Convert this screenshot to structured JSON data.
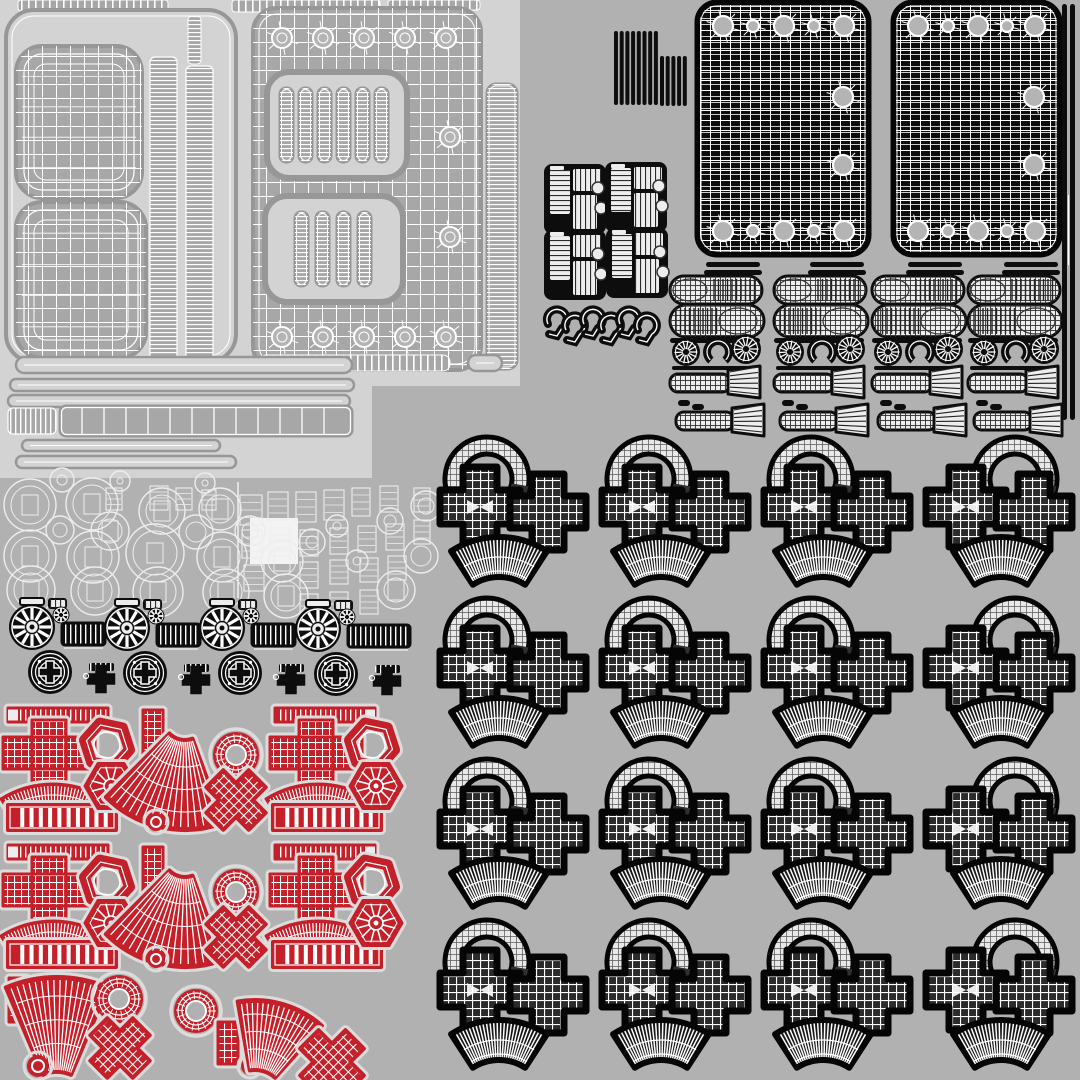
{
  "meta": {
    "description": "UV wireframe texture atlas sheet of 3D model parts",
    "canvas": {
      "w": 1080,
      "h": 1080
    }
  },
  "palette": {
    "bg": "#B1B1B1",
    "light": "#D3D3D3",
    "gray": "#A7A7A7",
    "grayEdge": "#979797",
    "white": "#FFFFFF",
    "ink": "#0D0D0D",
    "outline": "#050505",
    "meshDark": "#2B2B2B",
    "ringFill": "#E8E8E8",
    "red": "#C4202A",
    "halo": "#DCDCDC",
    "holeGray": "#B4B4B4",
    "fanDark": "#161616",
    "wireLight": "#EDEDED"
  },
  "patterns": [
    {
      "id": "gw7",
      "size": 7,
      "h": true,
      "v": true,
      "color": "#FFFFFF",
      "lw": 1.1
    },
    {
      "id": "gw8",
      "size": 8,
      "h": true,
      "v": true,
      "color": "#FFFFFF",
      "lw": 1.2
    },
    {
      "id": "gw10",
      "size": 10,
      "h": true,
      "v": true,
      "color": "#FFFFFF",
      "lw": 1.0
    },
    {
      "id": "hl6",
      "size": 6,
      "h": true,
      "v": false,
      "color": "#FFFFFF",
      "lw": 0.8
    },
    {
      "id": "gl14",
      "size": 14,
      "h": true,
      "v": true,
      "color": "#FFFFFF",
      "lw": 1.0
    },
    {
      "id": "gd6",
      "size": 6,
      "h": true,
      "v": true,
      "color": "#606060",
      "lw": 0.8
    },
    {
      "id": "sv5",
      "size": 5,
      "h": false,
      "v": true,
      "color": "#FFFFFF",
      "lw": 1.8
    },
    {
      "id": "sv7",
      "size": 7,
      "h": false,
      "v": true,
      "color": "#FFFFFF",
      "lw": 2.2
    },
    {
      "id": "sh4",
      "size": 4,
      "h": true,
      "v": false,
      "color": "#FFFFFF",
      "lw": 1.3
    },
    {
      "id": "shd5",
      "size": 5,
      "h": true,
      "v": false,
      "color": "#2A2A2A",
      "lw": 1.2
    },
    {
      "id": "svd5",
      "size": 5,
      "h": false,
      "v": true,
      "color": "#2A2A2A",
      "lw": 1.2
    },
    {
      "id": "gdk5",
      "size": 5,
      "h": true,
      "v": true,
      "color": "#2F2F2F",
      "lw": 0.9
    }
  ],
  "light_rects": [
    [
      0,
      0,
      520,
      386
    ],
    [
      0,
      0,
      372,
      478
    ]
  ],
  "top_bars": [
    [
      18,
      0,
      150,
      11
    ],
    [
      26,
      12,
      140,
      9
    ],
    [
      232,
      0,
      148,
      12
    ],
    [
      388,
      0,
      92,
      10
    ]
  ],
  "frame": {
    "x": 6,
    "y": 10,
    "w": 230,
    "h": 352,
    "r": 28
  },
  "pads": [
    [
      16,
      46,
      126,
      152,
      26
    ],
    [
      16,
      202,
      130,
      156,
      26
    ]
  ],
  "columns": [
    [
      150,
      57,
      27,
      305
    ],
    [
      186,
      66,
      27,
      296
    ]
  ],
  "minibar": [
    188,
    16,
    13,
    48
  ],
  "panel": {
    "x": 253,
    "y": 8,
    "w": 228,
    "h": 362,
    "r": 24,
    "holes_x": [
      282,
      323,
      364,
      405,
      446
    ],
    "holes_top_y": 38,
    "holes_bot_y": 337,
    "right_holes": [
      [
        450,
        137
      ],
      [
        450,
        237
      ]
    ],
    "cutouts": [
      {
        "x": 267,
        "y": 72,
        "w": 140,
        "h": 106,
        "r": 22,
        "slots": 6,
        "slot_x0": 280,
        "slot_pitch": 19,
        "slot_y": 88,
        "slot_w": 13,
        "slot_h": 74
      },
      {
        "x": 265,
        "y": 196,
        "w": 138,
        "h": 106,
        "r": 22,
        "slots": 4,
        "slot_x0": 295,
        "slot_pitch": 21,
        "slot_y": 212,
        "slot_w": 13,
        "slot_h": 74
      }
    ]
  },
  "side_strip": [
    487,
    84,
    30,
    285
  ],
  "long_bars": {
    "outline": [
      [
        16,
        357,
        336,
        16
      ],
      [
        468,
        355,
        34,
        16
      ]
    ],
    "striped": [
      [
        260,
        355,
        190,
        16
      ]
    ],
    "thin": [
      [
        10,
        379,
        344,
        12
      ],
      [
        8,
        395,
        342,
        12
      ],
      [
        22,
        440,
        198,
        11
      ],
      [
        16,
        456,
        220,
        12
      ]
    ],
    "seg_small": [
      8,
      408,
      48,
      26
    ],
    "seg_big": [
      60,
      406,
      292,
      30
    ]
  },
  "washers": {
    "line_x": 238,
    "blob": [
      250,
      518,
      48,
      46
    ],
    "circles": [
      [
        30,
        505,
        26
      ],
      [
        92,
        504,
        26
      ],
      [
        30,
        556,
        26
      ],
      [
        93,
        557,
        26
      ],
      [
        31,
        590,
        24
      ],
      [
        95,
        591,
        24
      ],
      [
        155,
        553,
        29
      ],
      [
        158,
        592,
        25
      ],
      [
        110,
        531,
        19
      ],
      [
        162,
        511,
        23
      ],
      [
        220,
        509,
        21
      ],
      [
        222,
        557,
        25
      ],
      [
        226,
        592,
        23
      ],
      [
        282,
        561,
        21
      ],
      [
        286,
        596,
        22
      ],
      [
        196,
        532,
        17
      ],
      [
        250,
        531,
        15
      ],
      [
        312,
        542,
        13
      ],
      [
        337,
        526,
        11
      ],
      [
        357,
        561,
        11
      ],
      [
        390,
        521,
        13
      ],
      [
        396,
        590,
        19
      ],
      [
        421,
        556,
        17
      ],
      [
        426,
        506,
        15
      ],
      [
        62,
        480,
        12
      ],
      [
        120,
        481,
        10
      ],
      [
        205,
        483,
        10
      ],
      [
        60,
        530,
        14
      ]
    ],
    "rects": [
      [
        240,
        495,
        22,
        30
      ],
      [
        268,
        492,
        20,
        28
      ],
      [
        296,
        492,
        20,
        30
      ],
      [
        324,
        490,
        20,
        30
      ],
      [
        352,
        488,
        18,
        28
      ],
      [
        380,
        486,
        18,
        26
      ],
      [
        242,
        530,
        20,
        28
      ],
      [
        270,
        528,
        20,
        28
      ],
      [
        300,
        530,
        18,
        26
      ],
      [
        330,
        528,
        18,
        26
      ],
      [
        358,
        526,
        18,
        26
      ],
      [
        386,
        524,
        18,
        26
      ],
      [
        244,
        565,
        20,
        26
      ],
      [
        300,
        562,
        18,
        26
      ],
      [
        330,
        560,
        18,
        24
      ],
      [
        360,
        558,
        18,
        24
      ],
      [
        388,
        556,
        18,
        24
      ],
      [
        414,
        488,
        16,
        24
      ],
      [
        414,
        520,
        16,
        24
      ],
      [
        150,
        486,
        18,
        24
      ],
      [
        176,
        488,
        16,
        22
      ],
      [
        202,
        490,
        14,
        20
      ],
      [
        106,
        488,
        16,
        22
      ],
      [
        300,
        594,
        18,
        24
      ],
      [
        330,
        592,
        18,
        24
      ],
      [
        360,
        590,
        18,
        24
      ]
    ]
  },
  "wheels": {
    "centers": [
      [
        32,
        627
      ],
      [
        127,
        628
      ],
      [
        222,
        628
      ],
      [
        318,
        629
      ]
    ],
    "bar_w": [
      43,
      43,
      43,
      62
    ]
  },
  "coil": {
    "tall": {
      "x": 614,
      "y": 31,
      "n": 8,
      "pitch": 5.7,
      "w": 4,
      "h": 74
    },
    "short": {
      "x": 660,
      "y": 56,
      "n": 5,
      "pitch": 5.7,
      "w": 4,
      "h": 50
    }
  },
  "connectors": [
    [
      548,
      168
    ],
    [
      609,
      166
    ],
    [
      548,
      234
    ],
    [
      610,
      232
    ]
  ],
  "hooks": {
    "x0": 548,
    "ys": [
      306,
      312
    ],
    "n": 6,
    "pitch": 18
  },
  "black_panels": [
    {
      "x": 697,
      "y": 2,
      "w": 172,
      "h": 253,
      "hx": [
        26,
        56,
        87,
        117,
        147
      ],
      "hr": [
        10,
        6,
        10,
        6,
        10
      ],
      "ry": [
        95,
        163
      ]
    },
    {
      "x": 893,
      "y": 2,
      "w": 167,
      "h": 253,
      "hx": [
        25,
        55,
        85,
        114,
        142
      ],
      "hr": [
        10,
        6,
        10,
        6,
        10
      ],
      "ry": [
        95,
        163
      ]
    }
  ],
  "edge_bars": [
    [
      1062,
      4,
      5,
      416
    ],
    [
      1070,
      4,
      5,
      416
    ]
  ],
  "grips": {
    "cols": [
      668,
      772,
      870,
      966
    ]
  },
  "pattern": {
    "cols": [
      430,
      592,
      754,
      916
    ],
    "rows": [
      437,
      598,
      759,
      920
    ],
    "ringdx": [
      57,
      57,
      57,
      99
    ],
    "fandx": [
      69,
      69,
      69,
      85
    ],
    "ring": {
      "r1": 25,
      "r2": 42,
      "a1": -215,
      "a2": 32,
      "cy": 42
    },
    "crossA": {
      "dx": 50,
      "dy": 70,
      "arm": 40,
      "hw": 17
    },
    "crossB": {
      "dx": 118,
      "dy": 75,
      "arm": 38,
      "hw": 16
    },
    "fan": {
      "cy": 188,
      "r1": 48,
      "r2": 88,
      "a1": -123,
      "a2": -57,
      "rays": 26
    }
  },
  "red": {
    "rows_dy": [
      0,
      137
    ],
    "template": [
      {
        "t": "tbar",
        "x": 8,
        "y": 708,
        "w": 100,
        "h": 14,
        "cap": "l"
      },
      {
        "t": "cross",
        "cx": 49,
        "cy": 753
      },
      {
        "t": "arc",
        "cx": 53,
        "cy": 882,
        "r1": 76,
        "r2": 98,
        "a1": -122,
        "a2": -58
      },
      {
        "t": "segbar",
        "x": 8,
        "y": 805,
        "w": 108,
        "h": 25
      },
      {
        "t": "hexnut",
        "cx": 107,
        "cy": 745,
        "r": 23,
        "rot": 12
      },
      {
        "t": "hexspoke",
        "cx": 111,
        "cy": 786,
        "r": 26,
        "rot": 0
      },
      {
        "t": "vbar",
        "x": 143,
        "y": 710,
        "w": 20,
        "h": 52
      },
      {
        "t": "fan",
        "cx": 185,
        "cy": 718,
        "r1": 22,
        "r2": 112,
        "a1": 70,
        "a2": 135
      },
      {
        "t": "dot",
        "cx": 156,
        "cy": 822,
        "r": 9
      },
      {
        "t": "donut",
        "cx": 236,
        "cy": 755,
        "r": 23,
        "hole": 10
      },
      {
        "t": "x",
        "cx": 236,
        "cy": 800,
        "arm": 30,
        "hw": 12
      },
      {
        "t": "tbar",
        "x": 275,
        "y": 708,
        "w": 100,
        "h": 14,
        "cap": "r"
      },
      {
        "t": "cross",
        "cx": 316,
        "cy": 753
      },
      {
        "t": "arc",
        "cx": 318,
        "cy": 882,
        "r1": 76,
        "r2": 98,
        "a1": -122,
        "a2": -58
      },
      {
        "t": "segbar",
        "x": 273,
        "y": 805,
        "w": 108,
        "h": 25
      },
      {
        "t": "hexnut",
        "cx": 372,
        "cy": 745,
        "r": 23,
        "rot": 12
      },
      {
        "t": "hexspoke",
        "cx": 376,
        "cy": 786,
        "r": 26,
        "rot": 0
      }
    ],
    "row3": [
      {
        "t": "vbar",
        "x": 9,
        "y": 978,
        "w": 18,
        "h": 44
      },
      {
        "t": "fan",
        "cx": 57,
        "cy": 1108,
        "r1": 36,
        "r2": 131,
        "a1": -113,
        "a2": -67
      },
      {
        "t": "dot",
        "cx": 38,
        "cy": 1066,
        "r": 11
      },
      {
        "t": "donut",
        "cx": 119,
        "cy": 999,
        "r": 24,
        "hole": 10
      },
      {
        "t": "x",
        "cx": 120,
        "cy": 1048,
        "arm": 30,
        "hw": 12
      },
      {
        "t": "donut",
        "cx": 196,
        "cy": 1011,
        "r": 22,
        "hole": 10
      },
      {
        "t": "vbar",
        "x": 218,
        "y": 1022,
        "w": 20,
        "h": 42
      },
      {
        "t": "dot",
        "cx": 250,
        "cy": 1066,
        "r": 9
      },
      {
        "t": "fan",
        "cx": 255,
        "cy": 1100,
        "r1": 30,
        "r2": 100,
        "a1": -100,
        "a2": -48
      },
      {
        "t": "x",
        "cx": 332,
        "cy": 1062,
        "arm": 32,
        "hw": 13
      }
    ]
  }
}
